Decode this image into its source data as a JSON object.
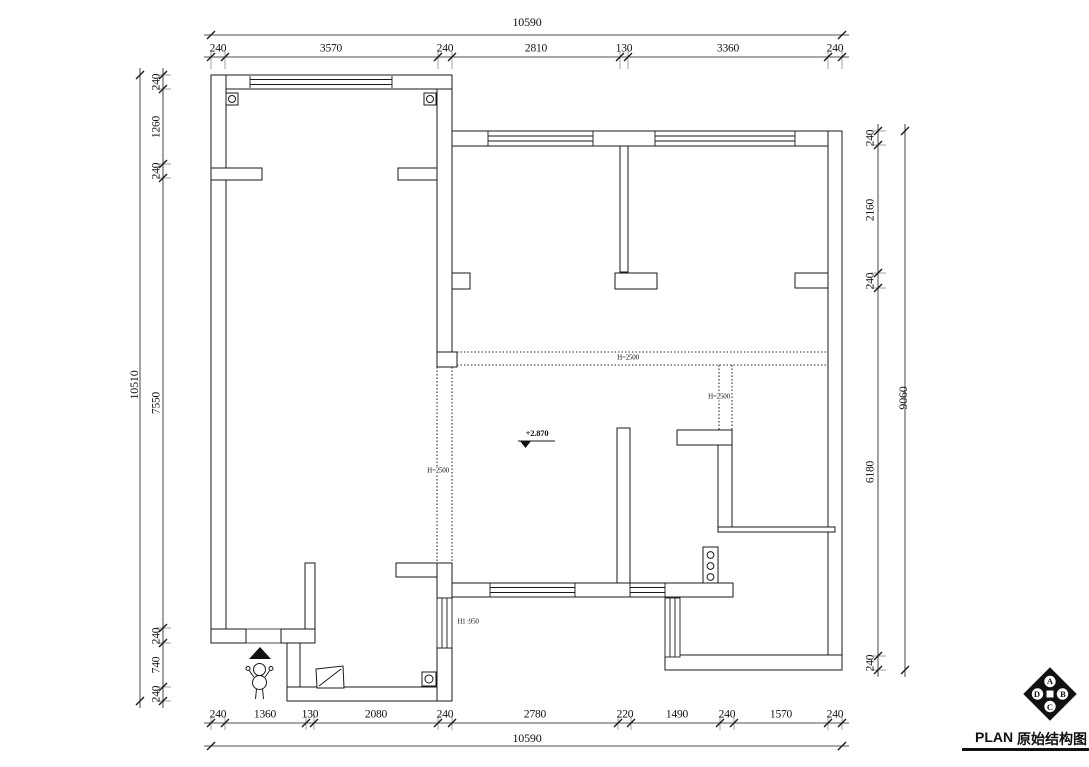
{
  "title": {
    "plan_label": "PLAN",
    "plan_name": "原始结构图"
  },
  "dims": {
    "top": {
      "overall": "10590",
      "segments": [
        "240",
        "3570",
        "240",
        "2810",
        "130",
        "3360",
        "240"
      ]
    },
    "bottom": {
      "overall": "10590",
      "segments": [
        "240",
        "1360",
        "130",
        "2080",
        "240",
        "2780",
        "220",
        "1490",
        "240",
        "1570",
        "240"
      ]
    },
    "left": {
      "overall": "10510",
      "segments": [
        "240",
        "1260",
        "240",
        "7550",
        "240",
        "740",
        "240"
      ]
    },
    "right": {
      "overall": "9060",
      "segments": [
        "240",
        "2160",
        "240",
        "6180",
        "240"
      ]
    }
  },
  "annotations": {
    "beam_mid": "H=2500",
    "beam_left": "H=2500",
    "beam_right": "H=2500",
    "level_mark": "+2.870",
    "window_height": "H1 :950"
  },
  "compass": {
    "letters": [
      "A",
      "B",
      "C",
      "D"
    ]
  },
  "colors": {
    "line": "#1a1a1a",
    "background": "#ffffff"
  }
}
